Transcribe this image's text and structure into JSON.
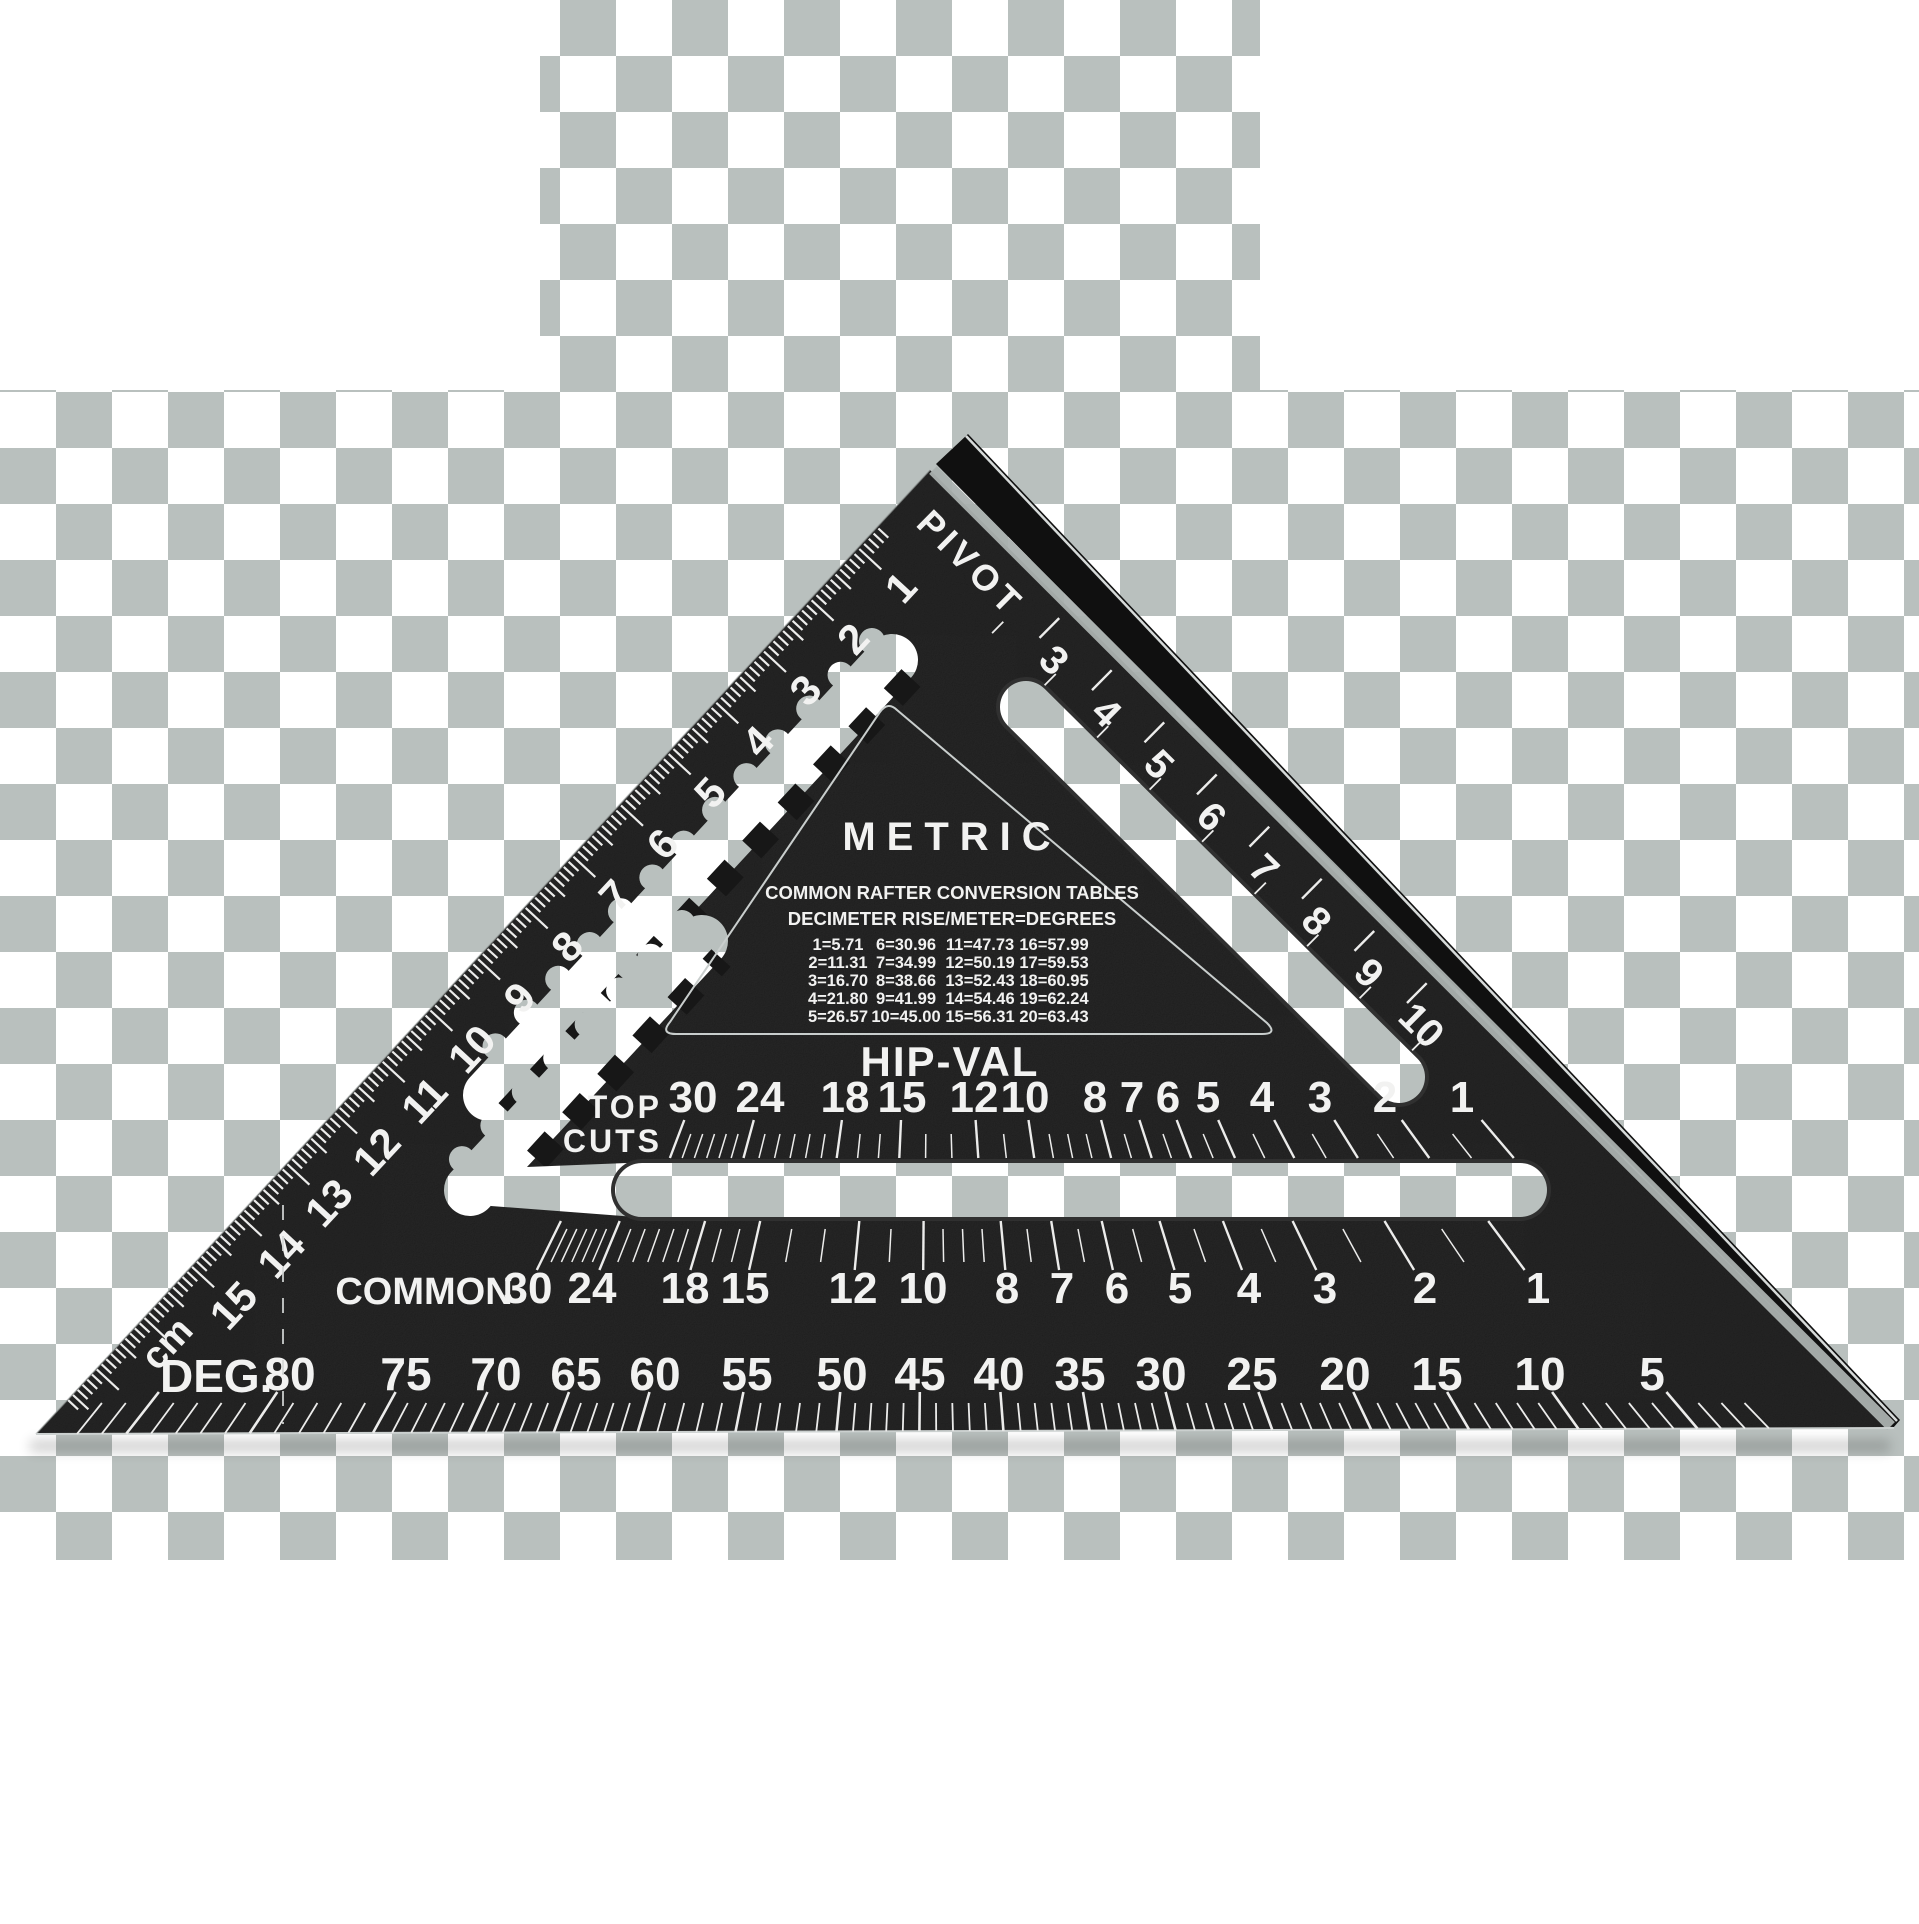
{
  "colors": {
    "body": "#171717",
    "fence": "#101010",
    "ink": "#f2f2f1",
    "tick": "#ececeb",
    "checker_light": "#ffffff",
    "checker_dark": "#b9c0be",
    "edge_stripe": "#aab1af",
    "edge_highlight": "#d6dad9"
  },
  "square": {
    "pivot_label": "PIVOT",
    "cm_scale": {
      "unit": "cm",
      "numbers": [
        1,
        2,
        3,
        4,
        5,
        6,
        7,
        8,
        9,
        10,
        11,
        12,
        13,
        14,
        15
      ]
    },
    "edge_scale": {
      "numbers": [
        3,
        4,
        5,
        6,
        7,
        8,
        9,
        10
      ]
    },
    "panel": {
      "title": "METRIC",
      "line1": "COMMON RAFTER CONVERSION TABLES",
      "line2": "DECIMETER RISE/METER=DEGREES",
      "table_rows": [
        [
          "1=5.71",
          "6=30.96",
          "11=47.73",
          "16=57.99"
        ],
        [
          "2=11.31",
          "7=34.99",
          "12=50.19",
          "17=59.53"
        ],
        [
          "3=16.70",
          "8=38.66",
          "13=52.43",
          "18=60.95"
        ],
        [
          "4=21.80",
          "9=41.99",
          "14=54.46",
          "19=62.24"
        ],
        [
          "5=26.57",
          "10=45.00",
          "15=56.31",
          "20=63.43"
        ]
      ],
      "hip_val_heading": "HIP-VAL"
    },
    "top_cuts_label": [
      "TOP",
      "CUTS"
    ],
    "hip_val_scale": {
      "values": [
        30,
        24,
        18,
        15,
        12,
        10,
        8,
        7,
        6,
        5,
        4,
        3,
        2,
        1
      ],
      "x": [
        693,
        760,
        845,
        902,
        974,
        1025,
        1095,
        1132,
        1168,
        1208,
        1262,
        1320,
        1385,
        1462
      ],
      "y_center": 1097
    },
    "common_scale": {
      "label": "COMMON",
      "values": [
        30,
        24,
        18,
        15,
        12,
        10,
        8,
        7,
        6,
        5,
        4,
        3,
        2,
        1
      ],
      "x": [
        528,
        592,
        685,
        745,
        853,
        923,
        1007,
        1062,
        1117,
        1180,
        1249,
        1325,
        1425,
        1538
      ],
      "y_center": 1288
    },
    "deg_scale": {
      "label": "DEG.",
      "values": [
        80,
        75,
        70,
        65,
        60,
        55,
        50,
        45,
        40,
        35,
        30,
        25,
        20,
        15,
        10,
        5
      ],
      "x": [
        290,
        406,
        496,
        576,
        655,
        747,
        842,
        920,
        999,
        1080,
        1161,
        1252,
        1345,
        1437,
        1540,
        1652
      ],
      "y_center": 1374
    }
  }
}
